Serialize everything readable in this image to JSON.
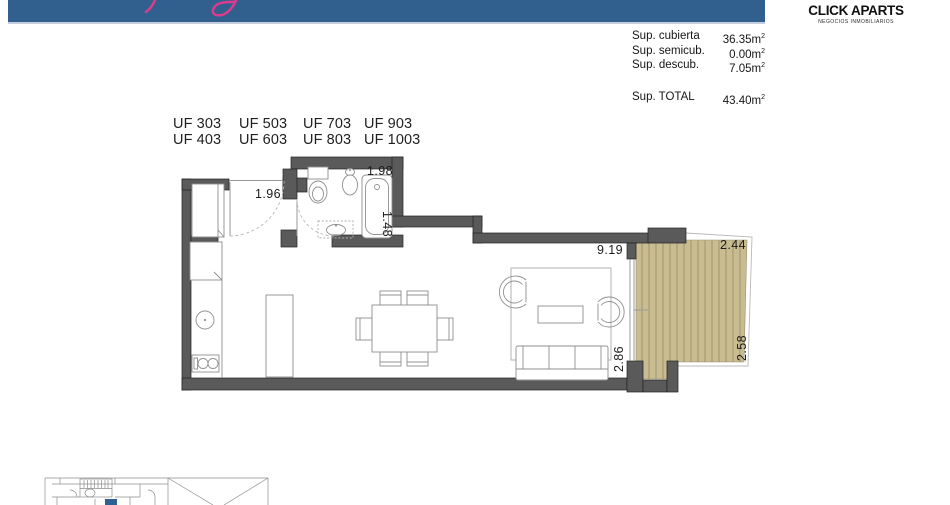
{
  "header": {
    "bar_color": "#31608f",
    "script_color": "#e13a8c"
  },
  "brand": {
    "name": "CLICK APARTS",
    "tagline": "NEGOCIOS INMOBILIARIOS"
  },
  "areas": {
    "rows": [
      {
        "label": "Sup. cubierta",
        "value": "36.35",
        "unit": "m",
        "sup": "2"
      },
      {
        "label": "Sup. semicub.",
        "value": "0.00",
        "unit": "m",
        "sup": "2"
      },
      {
        "label": "Sup. descub.",
        "value": "7.05",
        "unit": "m",
        "sup": "2"
      }
    ],
    "total": {
      "label": "Sup. TOTAL",
      "value": "43.40",
      "unit": "m",
      "sup": "2"
    }
  },
  "units": {
    "cells": [
      "UF 303",
      "UF 503",
      "UF 703",
      "UF 903",
      "UF 403",
      "UF 603",
      "UF 803",
      "UF 1003"
    ]
  },
  "plan": {
    "dims": {
      "entry": "1.96",
      "bath_w": "1.98",
      "bath_h": "1.48",
      "living_w": "9.19",
      "deck_w": "2.44",
      "deck_h": "2.58",
      "living_h": "2.86"
    },
    "colors": {
      "wall": "#5a5a5a",
      "deck": "#c9bc90",
      "keyplan_highlight": "#2e6191"
    }
  }
}
